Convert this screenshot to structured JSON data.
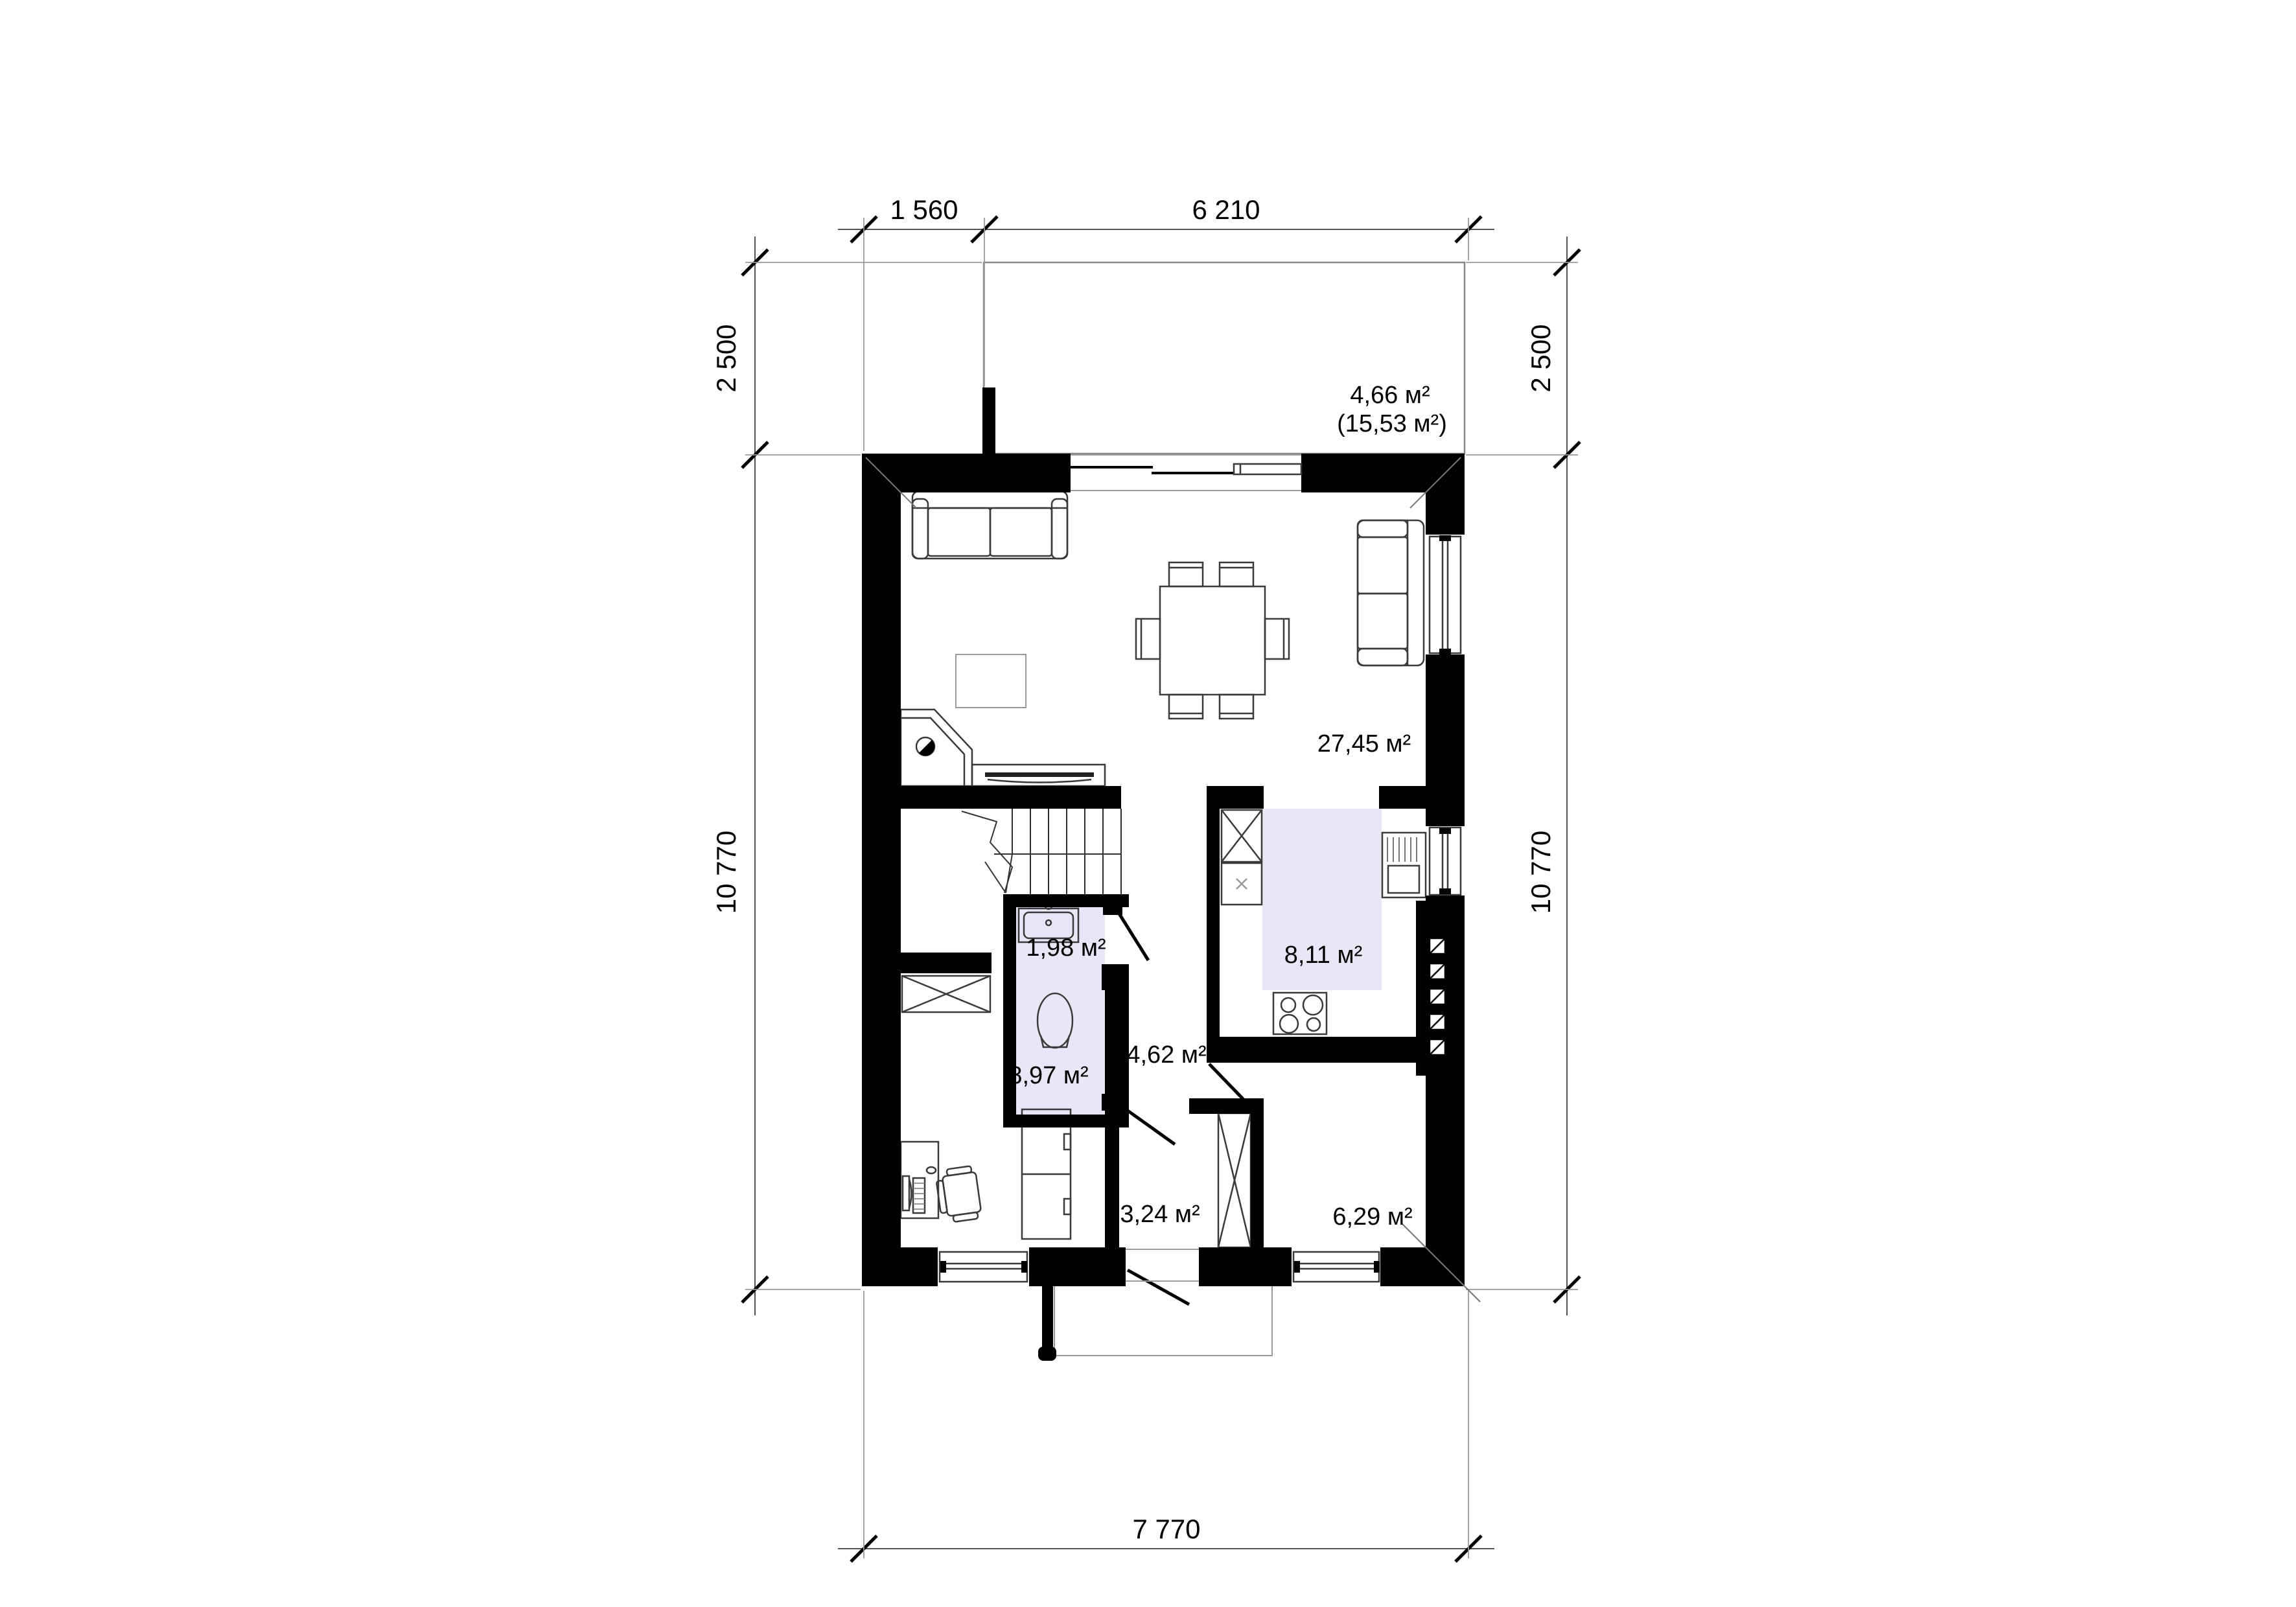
{
  "drawing": {
    "type": "architectural-floor-plan",
    "dim_labels": {
      "top": [
        "1 560",
        "6 210"
      ],
      "left": [
        "2 500",
        "10 770"
      ],
      "right": [
        "2 500",
        "10 770"
      ],
      "bottom": [
        "7 770"
      ]
    },
    "area_labels": {
      "terrace": "4,66 м²",
      "terrace_total": "(15,53 м²)",
      "living_dining": "27,45 м²",
      "wc": "1,98 м²",
      "kitchen": "8,11 м²",
      "hall": "4,62 м²",
      "office": "8,97 м²",
      "vestibule": "3,24 м²",
      "back_room": "6,29 м²"
    },
    "colors": {
      "wall": "#000000",
      "room_fill": "#e7e7f8",
      "dim_line": "#555555",
      "ext_line": "#999999",
      "furniture_line": "#3a3a3a",
      "terrace_line": "#8a8a8a"
    }
  }
}
